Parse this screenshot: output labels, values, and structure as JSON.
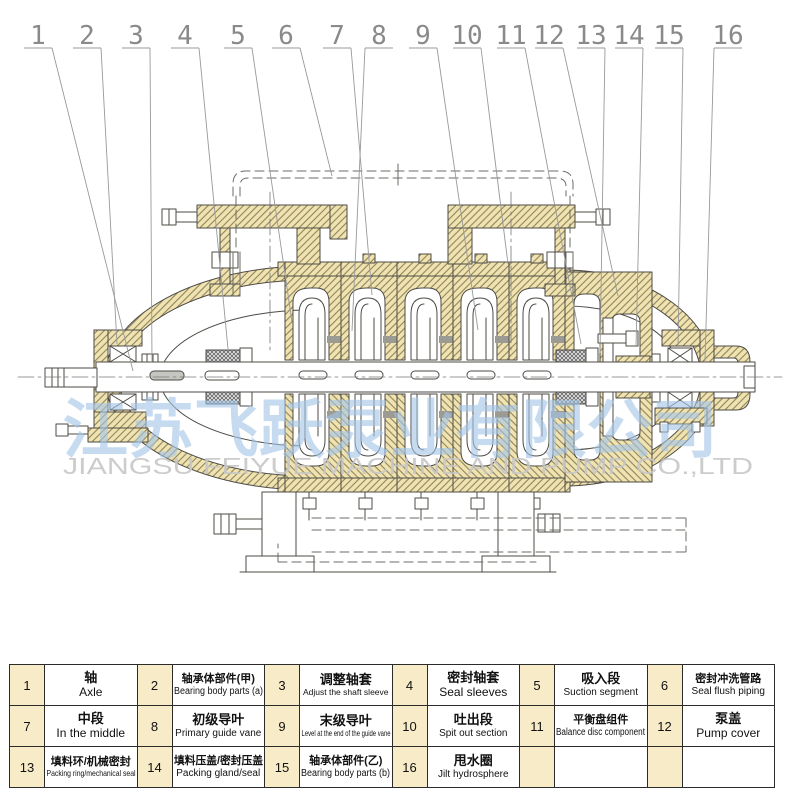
{
  "callouts": [
    "1",
    "2",
    "3",
    "4",
    "5",
    "6",
    "7",
    "8",
    "9",
    "10",
    "11",
    "12",
    "13",
    "14",
    "15",
    "16"
  ],
  "watermark": {
    "cn": "江苏飞跃泵业有限公司",
    "en": "JIANGSU FEIYUE MACHINE AND PUMP CO.,LTD"
  },
  "colors": {
    "casing_fill": "#f0e3ae",
    "hatch_line": "#8d8465",
    "outline": "#4d4b46",
    "number_cell_bg": "#f8ecc8",
    "watermark_blue": "#a5c6e8",
    "watermark_gray": "#c7c7c7"
  },
  "table": {
    "rows": [
      [
        {
          "no": "1",
          "cn": "轴",
          "en": "Axle"
        },
        {
          "no": "2",
          "cn": "轴承体部件(甲)",
          "en": "Bearing body parts (a)"
        },
        {
          "no": "3",
          "cn": "调整轴套",
          "en": "Adjust the shaft sleeve"
        },
        {
          "no": "4",
          "cn": "密封轴套",
          "en": "Seal sleeves"
        },
        {
          "no": "5",
          "cn": "吸入段",
          "en": "Suction segment"
        },
        {
          "no": "6",
          "cn": "密封冲洗管路",
          "en": "Seal flush piping"
        }
      ],
      [
        {
          "no": "7",
          "cn": "中段",
          "en": "In the middle"
        },
        {
          "no": "8",
          "cn": "初级导叶",
          "en": "Primary guide vane"
        },
        {
          "no": "9",
          "cn": "末级导叶",
          "en": "Level at the end of the guide vane"
        },
        {
          "no": "10",
          "cn": "吐出段",
          "en": "Spit out section"
        },
        {
          "no": "11",
          "cn": "平衡盘组件",
          "en": "Balance disc component"
        },
        {
          "no": "12",
          "cn": "泵盖",
          "en": "Pump cover"
        }
      ],
      [
        {
          "no": "13",
          "cn": "填料环/机械密封",
          "en": "Packing ring/mechanical seal"
        },
        {
          "no": "14",
          "cn": "填料压盖/密封压盖",
          "en": "Packing gland/seal"
        },
        {
          "no": "15",
          "cn": "轴承体部件(乙)",
          "en": "Bearing body parts (b)"
        },
        {
          "no": "16",
          "cn": "甩水圈",
          "en": "Jilt hydrosphere"
        },
        {
          "no": "",
          "cn": "",
          "en": ""
        },
        {
          "no": "",
          "cn": "",
          "en": ""
        }
      ]
    ]
  }
}
